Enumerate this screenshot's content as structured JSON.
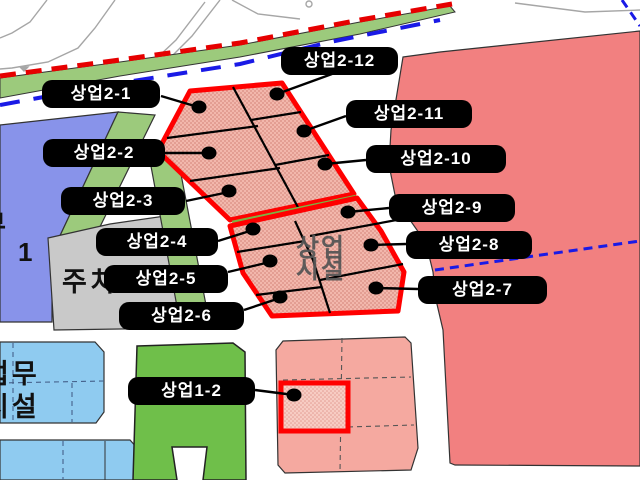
{
  "map": {
    "parcel_labels": [
      {
        "id": "sangeop-2-1",
        "text": "상업2-1"
      },
      {
        "id": "sangeop-2-12",
        "text": "상업2-12"
      },
      {
        "id": "sangeop-2-2",
        "text": "상업2-2"
      },
      {
        "id": "sangeop-2-11",
        "text": "상업2-11"
      },
      {
        "id": "sangeop-2-10",
        "text": "상업2-10"
      },
      {
        "id": "sangeop-2-3",
        "text": "상업2-3"
      },
      {
        "id": "sangeop-2-9",
        "text": "상업2-9"
      },
      {
        "id": "sangeop-2-4",
        "text": "상업2-4"
      },
      {
        "id": "sangeop-2-8",
        "text": "상업2-8"
      },
      {
        "id": "sangeop-2-5",
        "text": "상업2-5"
      },
      {
        "id": "sangeop-2-7",
        "text": "상업2-7"
      },
      {
        "id": "sangeop-2-6",
        "text": "상업2-6"
      },
      {
        "id": "sangeop-1-2",
        "text": "상업1-2"
      }
    ],
    "center_area_label": {
      "line1": "상업",
      "line2": "시설"
    },
    "parking_label": "주차",
    "business_facility_label": {
      "line1": "업무",
      "line2": "시설"
    },
    "left_edge_label": {
      "partial_char": "부",
      "number": "1"
    },
    "colors": {
      "commercial_hatched_fill": "#F2B7AC",
      "commercial_solid_fill": "#F28080",
      "commercial_light_fill": "#F5A9A0",
      "boundary_red": "#FF0000",
      "planning_line_red_dashed": "#E60000",
      "planning_line_blue_dashed": "#1A1AE6",
      "green_buffer": "#9CCA7C",
      "park_green": "#6FBF4A",
      "residential_blue": "#8893EA",
      "office_blue": "#8FCBF0",
      "parking_gray": "#C9C9C9"
    }
  }
}
